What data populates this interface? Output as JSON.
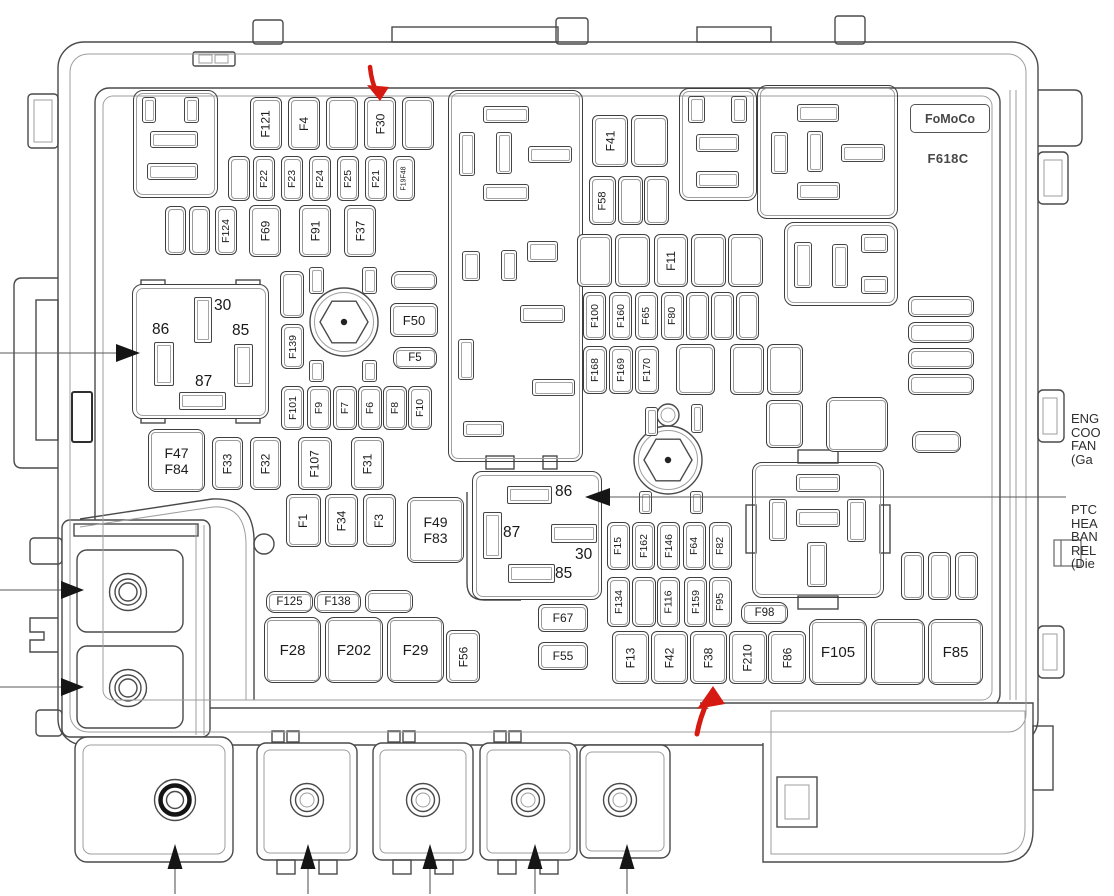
{
  "title_block": {
    "brand": "FoMoCo",
    "part_code": "F618C"
  },
  "callouts": {
    "engine_fan": "ENG\nCOO\nFAN\n(Ga",
    "ptc_heater": "PTC\nHEA\nBAN\nREL\n(Die"
  },
  "relay_left": {
    "pin_top": "30",
    "pin_left": "86",
    "pin_right": "85",
    "pin_bottom": "87"
  },
  "relay_middle": {
    "pin_top": "86",
    "pin_left": "87",
    "pin_center": "30",
    "pin_bottom": "85"
  },
  "colors": {
    "annotation_red": "#d61a12",
    "line_dark": "#4a4a4a",
    "line_light": "#9e9e9e"
  },
  "boxes": [
    {
      "name": "footprint-top-left",
      "x": 133,
      "y": 90,
      "w": 85,
      "h": 108
    },
    {
      "name": "footprint-top-right-a",
      "x": 679,
      "y": 88,
      "w": 78,
      "h": 113
    },
    {
      "name": "footprint-top-right-b",
      "x": 757,
      "y": 85,
      "w": 141,
      "h": 134
    },
    {
      "name": "footprint-top-right-c",
      "x": 784,
      "y": 222,
      "w": 114,
      "h": 84
    },
    {
      "name": "relay-footprint-ptc",
      "x": 752,
      "y": 462,
      "w": 132,
      "h": 136
    },
    {
      "name": "center-module-block",
      "x": 448,
      "y": 90,
      "w": 135,
      "h": 372
    }
  ],
  "fuses": [
    {
      "label": "F121",
      "x": 250,
      "y": 97,
      "w": 32,
      "h": 53,
      "v": 1
    },
    {
      "label": "F4",
      "x": 288,
      "y": 97,
      "w": 32,
      "h": 53,
      "v": 1
    },
    {
      "label": "F30",
      "x": 364,
      "y": 97,
      "w": 32,
      "h": 53,
      "v": 1
    },
    {
      "label": "F22",
      "x": 253,
      "y": 156,
      "w": 22,
      "h": 45,
      "v": 1,
      "fs": 10.5
    },
    {
      "label": "F23",
      "x": 281,
      "y": 156,
      "w": 22,
      "h": 45,
      "v": 1,
      "fs": 10.5
    },
    {
      "label": "F24",
      "x": 309,
      "y": 156,
      "w": 22,
      "h": 45,
      "v": 1,
      "fs": 10.5
    },
    {
      "label": "F25",
      "x": 337,
      "y": 156,
      "w": 22,
      "h": 45,
      "v": 1,
      "fs": 10.5
    },
    {
      "label": "F21",
      "x": 365,
      "y": 156,
      "w": 22,
      "h": 45,
      "v": 1,
      "fs": 10.5
    },
    {
      "label": "F19F48",
      "x": 393,
      "y": 156,
      "w": 22,
      "h": 45,
      "v": 1,
      "fs": 7
    },
    {
      "label": "F124",
      "x": 215,
      "y": 206,
      "w": 22,
      "h": 49,
      "v": 1,
      "fs": 10.5
    },
    {
      "label": "F69",
      "x": 249,
      "y": 205,
      "w": 32,
      "h": 52,
      "v": 1
    },
    {
      "label": "F91",
      "x": 299,
      "y": 205,
      "w": 32,
      "h": 52,
      "v": 1
    },
    {
      "label": "F37",
      "x": 344,
      "y": 205,
      "w": 32,
      "h": 52,
      "v": 1
    },
    {
      "label": "F139",
      "x": 281,
      "y": 324,
      "w": 23,
      "h": 45,
      "v": 1,
      "fs": 10.5
    },
    {
      "label": "F50",
      "x": 390,
      "y": 303,
      "w": 48,
      "h": 34,
      "fs": 13
    },
    {
      "label": "F5",
      "x": 393,
      "y": 347,
      "w": 44,
      "h": 22,
      "fs": 11.5,
      "r": 9
    },
    {
      "label": "F101",
      "x": 281,
      "y": 386,
      "w": 23,
      "h": 44,
      "v": 1,
      "fs": 10.5
    },
    {
      "label": "F9",
      "x": 307,
      "y": 386,
      "w": 24,
      "h": 44,
      "v": 1,
      "fs": 10.5
    },
    {
      "label": "F7",
      "x": 333,
      "y": 386,
      "w": 24,
      "h": 44,
      "v": 1,
      "fs": 10.5
    },
    {
      "label": "F6",
      "x": 358,
      "y": 386,
      "w": 24,
      "h": 44,
      "v": 1,
      "fs": 10.5
    },
    {
      "label": "F8",
      "x": 383,
      "y": 386,
      "w": 24,
      "h": 44,
      "v": 1,
      "fs": 10.5
    },
    {
      "label": "F10",
      "x": 408,
      "y": 386,
      "w": 24,
      "h": 44,
      "v": 1,
      "fs": 10.5
    },
    {
      "lines": [
        "F47",
        "F84"
      ],
      "x": 148,
      "y": 429,
      "w": 57,
      "h": 63,
      "fs": 14,
      "r": 8
    },
    {
      "label": "F33",
      "x": 212,
      "y": 437,
      "w": 31,
      "h": 53,
      "v": 1
    },
    {
      "label": "F32",
      "x": 250,
      "y": 437,
      "w": 31,
      "h": 53,
      "v": 1
    },
    {
      "label": "F107",
      "x": 298,
      "y": 437,
      "w": 34,
      "h": 53,
      "v": 1
    },
    {
      "label": "F31",
      "x": 351,
      "y": 437,
      "w": 33,
      "h": 53,
      "v": 1
    },
    {
      "label": "F1",
      "x": 286,
      "y": 494,
      "w": 35,
      "h": 53,
      "v": 1
    },
    {
      "label": "F34",
      "x": 325,
      "y": 494,
      "w": 33,
      "h": 53,
      "v": 1
    },
    {
      "label": "F3",
      "x": 363,
      "y": 494,
      "w": 33,
      "h": 53,
      "v": 1
    },
    {
      "lines": [
        "F49",
        "F83"
      ],
      "x": 407,
      "y": 497,
      "w": 57,
      "h": 66,
      "fs": 14,
      "r": 8
    },
    {
      "label": "F125",
      "x": 266,
      "y": 591,
      "w": 47,
      "h": 22,
      "fs": 11.5,
      "r": 9
    },
    {
      "label": "F138",
      "x": 314,
      "y": 591,
      "w": 47,
      "h": 22,
      "fs": 11.5,
      "r": 9
    },
    {
      "label": "F28",
      "x": 264,
      "y": 617,
      "w": 57,
      "h": 66,
      "fs": 15,
      "r": 9
    },
    {
      "label": "F202",
      "x": 325,
      "y": 617,
      "w": 58,
      "h": 66,
      "fs": 15,
      "r": 9
    },
    {
      "label": "F29",
      "x": 387,
      "y": 617,
      "w": 57,
      "h": 66,
      "fs": 15,
      "r": 9
    },
    {
      "label": "F56",
      "x": 446,
      "y": 630,
      "w": 34,
      "h": 53,
      "v": 1
    },
    {
      "label": "F67",
      "x": 538,
      "y": 604,
      "w": 50,
      "h": 28,
      "fs": 12,
      "r": 6
    },
    {
      "label": "F55",
      "x": 538,
      "y": 642,
      "w": 50,
      "h": 28,
      "fs": 12,
      "r": 6
    },
    {
      "label": "F41",
      "x": 592,
      "y": 115,
      "w": 36,
      "h": 52,
      "v": 1
    },
    {
      "label": "F58",
      "x": 589,
      "y": 176,
      "w": 27,
      "h": 49,
      "v": 1,
      "fs": 11
    },
    {
      "label": "F11",
      "x": 654,
      "y": 234,
      "w": 34,
      "h": 53,
      "v": 1
    },
    {
      "label": "F100",
      "x": 583,
      "y": 292,
      "w": 23,
      "h": 48,
      "v": 1,
      "fs": 10.5
    },
    {
      "label": "F160",
      "x": 609,
      "y": 292,
      "w": 23,
      "h": 48,
      "v": 1,
      "fs": 10.5
    },
    {
      "label": "F65",
      "x": 635,
      "y": 292,
      "w": 23,
      "h": 48,
      "v": 1,
      "fs": 10.5
    },
    {
      "label": "F80",
      "x": 661,
      "y": 292,
      "w": 23,
      "h": 48,
      "v": 1,
      "fs": 10.5
    },
    {
      "label": "F168",
      "x": 583,
      "y": 346,
      "w": 24,
      "h": 48,
      "v": 1,
      "fs": 10.5
    },
    {
      "label": "F169",
      "x": 609,
      "y": 346,
      "w": 24,
      "h": 48,
      "v": 1,
      "fs": 10.5
    },
    {
      "label": "F170",
      "x": 635,
      "y": 346,
      "w": 24,
      "h": 48,
      "v": 1,
      "fs": 10.5
    },
    {
      "label": "F15",
      "x": 607,
      "y": 522,
      "w": 23,
      "h": 48,
      "v": 1,
      "fs": 10.5
    },
    {
      "label": "F162",
      "x": 632,
      "y": 522,
      "w": 23,
      "h": 48,
      "v": 1,
      "fs": 10.5
    },
    {
      "label": "F146",
      "x": 657,
      "y": 522,
      "w": 23,
      "h": 48,
      "v": 1,
      "fs": 10.5
    },
    {
      "label": "F64",
      "x": 683,
      "y": 522,
      "w": 23,
      "h": 48,
      "v": 1,
      "fs": 10.5
    },
    {
      "label": "F82",
      "x": 709,
      "y": 522,
      "w": 23,
      "h": 48,
      "v": 1,
      "fs": 10.5
    },
    {
      "label": "F134",
      "x": 607,
      "y": 577,
      "w": 23,
      "h": 50,
      "v": 1,
      "fs": 10.5
    },
    {
      "label": "F116",
      "x": 657,
      "y": 577,
      "w": 23,
      "h": 50,
      "v": 1,
      "fs": 10.5
    },
    {
      "label": "F159",
      "x": 684,
      "y": 577,
      "w": 23,
      "h": 50,
      "v": 1,
      "fs": 10.5
    },
    {
      "label": "F95",
      "x": 709,
      "y": 577,
      "w": 23,
      "h": 50,
      "v": 1,
      "fs": 10.5
    },
    {
      "label": "F98",
      "x": 741,
      "y": 602,
      "w": 47,
      "h": 22,
      "fs": 11.5,
      "r": 9
    },
    {
      "label": "F13",
      "x": 612,
      "y": 631,
      "w": 37,
      "h": 53,
      "v": 1
    },
    {
      "label": "F42",
      "x": 651,
      "y": 631,
      "w": 37,
      "h": 53,
      "v": 1
    },
    {
      "label": "F38",
      "x": 690,
      "y": 631,
      "w": 37,
      "h": 53,
      "v": 1
    },
    {
      "label": "F210",
      "x": 729,
      "y": 631,
      "w": 38,
      "h": 53,
      "v": 1
    },
    {
      "label": "F86",
      "x": 768,
      "y": 631,
      "w": 38,
      "h": 53,
      "v": 1
    },
    {
      "label": "F105",
      "x": 809,
      "y": 619,
      "w": 58,
      "h": 66,
      "fs": 15,
      "r": 9
    },
    {
      "label": "F85",
      "x": 928,
      "y": 619,
      "w": 55,
      "h": 66,
      "fs": 15,
      "r": 9
    }
  ],
  "blank_slots": [
    {
      "x": 326,
      "y": 97,
      "w": 32,
      "h": 53
    },
    {
      "x": 402,
      "y": 97,
      "w": 32,
      "h": 53
    },
    {
      "x": 228,
      "y": 156,
      "w": 22,
      "h": 45
    },
    {
      "x": 165,
      "y": 206,
      "w": 21,
      "h": 49
    },
    {
      "x": 189,
      "y": 206,
      "w": 21,
      "h": 49
    },
    {
      "x": 280,
      "y": 271,
      "w": 24,
      "h": 47
    },
    {
      "x": 391,
      "y": 271,
      "w": 46,
      "h": 19,
      "r": 8
    },
    {
      "x": 631,
      "y": 115,
      "w": 37,
      "h": 52
    },
    {
      "x": 618,
      "y": 176,
      "w": 25,
      "h": 49
    },
    {
      "x": 644,
      "y": 176,
      "w": 25,
      "h": 49
    },
    {
      "x": 577,
      "y": 234,
      "w": 35,
      "h": 53
    },
    {
      "x": 615,
      "y": 234,
      "w": 35,
      "h": 53
    },
    {
      "x": 691,
      "y": 234,
      "w": 35,
      "h": 53
    },
    {
      "x": 728,
      "y": 234,
      "w": 35,
      "h": 53
    },
    {
      "x": 686,
      "y": 292,
      "w": 23,
      "h": 48
    },
    {
      "x": 711,
      "y": 292,
      "w": 23,
      "h": 48
    },
    {
      "x": 736,
      "y": 292,
      "w": 23,
      "h": 48
    },
    {
      "x": 676,
      "y": 344,
      "w": 39,
      "h": 51
    },
    {
      "x": 730,
      "y": 344,
      "w": 34,
      "h": 51
    },
    {
      "x": 767,
      "y": 344,
      "w": 36,
      "h": 51
    },
    {
      "x": 766,
      "y": 400,
      "w": 37,
      "h": 48
    },
    {
      "x": 826,
      "y": 397,
      "w": 62,
      "h": 55,
      "r": 8
    },
    {
      "x": 908,
      "y": 296,
      "w": 66,
      "h": 21,
      "r": 7
    },
    {
      "x": 908,
      "y": 322,
      "w": 66,
      "h": 21,
      "r": 7
    },
    {
      "x": 908,
      "y": 348,
      "w": 66,
      "h": 21,
      "r": 7
    },
    {
      "x": 908,
      "y": 374,
      "w": 66,
      "h": 21,
      "r": 7
    },
    {
      "x": 912,
      "y": 431,
      "w": 49,
      "h": 22,
      "r": 8
    },
    {
      "x": 632,
      "y": 577,
      "w": 24,
      "h": 50
    },
    {
      "x": 365,
      "y": 590,
      "w": 48,
      "h": 23,
      "r": 8
    },
    {
      "x": 871,
      "y": 619,
      "w": 54,
      "h": 66,
      "r": 9
    },
    {
      "x": 901,
      "y": 552,
      "w": 23,
      "h": 48
    },
    {
      "x": 928,
      "y": 552,
      "w": 23,
      "h": 48
    },
    {
      "x": 955,
      "y": 552,
      "w": 23,
      "h": 48
    }
  ],
  "pin_slots": [
    {
      "x": 142,
      "y": 97,
      "w": 14,
      "h": 26
    },
    {
      "x": 184,
      "y": 97,
      "w": 15,
      "h": 26
    },
    {
      "x": 150,
      "y": 131,
      "w": 48,
      "h": 17
    },
    {
      "x": 147,
      "y": 163,
      "w": 51,
      "h": 17
    },
    {
      "x": 483,
      "y": 106,
      "w": 46,
      "h": 17
    },
    {
      "x": 459,
      "y": 132,
      "w": 16,
      "h": 44
    },
    {
      "x": 496,
      "y": 132,
      "w": 16,
      "h": 42
    },
    {
      "x": 528,
      "y": 146,
      "w": 44,
      "h": 17
    },
    {
      "x": 483,
      "y": 184,
      "w": 46,
      "h": 17
    },
    {
      "x": 462,
      "y": 251,
      "w": 18,
      "h": 30
    },
    {
      "x": 501,
      "y": 250,
      "w": 16,
      "h": 31
    },
    {
      "x": 527,
      "y": 241,
      "w": 31,
      "h": 21
    },
    {
      "x": 520,
      "y": 305,
      "w": 45,
      "h": 18
    },
    {
      "x": 458,
      "y": 339,
      "w": 16,
      "h": 41
    },
    {
      "x": 532,
      "y": 379,
      "w": 43,
      "h": 17
    },
    {
      "x": 463,
      "y": 421,
      "w": 41,
      "h": 16
    },
    {
      "x": 688,
      "y": 96,
      "w": 17,
      "h": 27
    },
    {
      "x": 731,
      "y": 96,
      "w": 16,
      "h": 27
    },
    {
      "x": 696,
      "y": 134,
      "w": 43,
      "h": 18
    },
    {
      "x": 696,
      "y": 171,
      "w": 43,
      "h": 17
    },
    {
      "x": 797,
      "y": 104,
      "w": 42,
      "h": 18
    },
    {
      "x": 771,
      "y": 132,
      "w": 17,
      "h": 42
    },
    {
      "x": 807,
      "y": 131,
      "w": 16,
      "h": 41
    },
    {
      "x": 841,
      "y": 144,
      "w": 44,
      "h": 18
    },
    {
      "x": 797,
      "y": 182,
      "w": 43,
      "h": 18
    },
    {
      "x": 794,
      "y": 242,
      "w": 18,
      "h": 46
    },
    {
      "x": 832,
      "y": 244,
      "w": 16,
      "h": 44
    },
    {
      "x": 861,
      "y": 234,
      "w": 27,
      "h": 19
    },
    {
      "x": 861,
      "y": 276,
      "w": 27,
      "h": 18
    },
    {
      "x": 796,
      "y": 474,
      "w": 44,
      "h": 18
    },
    {
      "x": 769,
      "y": 499,
      "w": 18,
      "h": 42
    },
    {
      "x": 796,
      "y": 509,
      "w": 44,
      "h": 18
    },
    {
      "x": 847,
      "y": 499,
      "w": 19,
      "h": 43
    },
    {
      "x": 807,
      "y": 542,
      "w": 20,
      "h": 45
    },
    {
      "x": 309,
      "y": 267,
      "w": 15,
      "h": 27
    },
    {
      "x": 362,
      "y": 267,
      "w": 15,
      "h": 27
    },
    {
      "x": 309,
      "y": 360,
      "w": 15,
      "h": 22
    },
    {
      "x": 362,
      "y": 360,
      "w": 15,
      "h": 22
    },
    {
      "x": 645,
      "y": 407,
      "w": 13,
      "h": 29
    },
    {
      "x": 691,
      "y": 404,
      "w": 12,
      "h": 29
    },
    {
      "x": 639,
      "y": 491,
      "w": 13,
      "h": 23
    },
    {
      "x": 690,
      "y": 491,
      "w": 13,
      "h": 23
    }
  ]
}
